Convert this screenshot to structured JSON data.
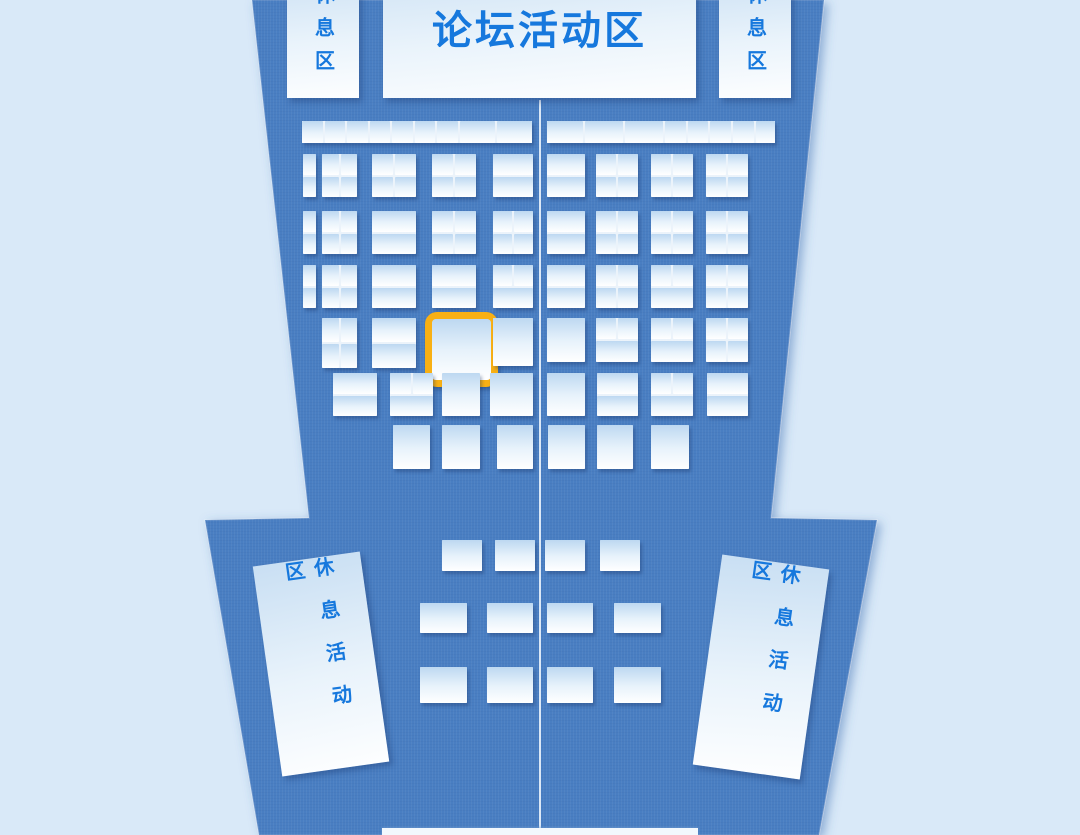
{
  "colors": {
    "background": "#d9e9f8",
    "hall_floor": "#4a7ec2",
    "hall_edge_shadow": "#3a6db0",
    "booth_top": "#bdd8f1",
    "booth_bottom": "#ffffff",
    "label_blue": "#1678dd",
    "highlight_accent": "#f8b014"
  },
  "hall": {
    "outline": [
      [
        252,
        0
      ],
      [
        824,
        0
      ],
      [
        771,
        518
      ],
      [
        877,
        520
      ],
      [
        819,
        835
      ],
      [
        259,
        835
      ],
      [
        205,
        520
      ],
      [
        309,
        518
      ]
    ]
  },
  "aisle": {
    "x": 539,
    "y": 100,
    "w": 2,
    "h": 728
  },
  "entrance": {
    "x": 382,
    "y": 828,
    "w": 316,
    "h": 7
  },
  "panels": {
    "forum": {
      "label": "论坛活动区",
      "x": 383,
      "y": -45,
      "w": 313,
      "h": 143,
      "angle": 0
    },
    "rest_top_left": {
      "label": "休息区",
      "x": 287,
      "y": -32,
      "w": 72,
      "h": 130,
      "angle": 0
    },
    "rest_top_right": {
      "label": "休息区",
      "x": 719,
      "y": -32,
      "w": 72,
      "h": 130,
      "angle": 0
    },
    "rest_bottom_left": {
      "label": "休息活动区",
      "x": 267,
      "y": 558,
      "w": 108,
      "h": 212,
      "angle": -8
    },
    "rest_bottom_right": {
      "label": "休息活动区",
      "x": 707,
      "y": 561,
      "w": 108,
      "h": 212,
      "angle": 8
    }
  },
  "booth_map": {
    "selected_booth_present": true,
    "cluster_types": {
      "s": "single booth",
      "v": "two stacked booths",
      "q": "2x2 booth block",
      "t": "two top booths + one wide bottom booth",
      "cols": "strip of stalls"
    },
    "clusters": [
      {
        "x": 302,
        "y": 121,
        "w": 230,
        "h": 22,
        "t": "cols",
        "cols": [
          22,
          22,
          22,
          22,
          22,
          22,
          22,
          37,
          38
        ]
      },
      {
        "x": 547,
        "y": 121,
        "w": 228,
        "h": 22,
        "t": "cols",
        "cols": [
          38,
          40,
          40,
          22,
          22,
          22,
          22,
          20
        ]
      },
      {
        "x": 303,
        "y": 154,
        "w": 13,
        "h": 43,
        "t": "v"
      },
      {
        "x": 322,
        "y": 154,
        "w": 35,
        "h": 43,
        "t": "q"
      },
      {
        "x": 372,
        "y": 154,
        "w": 44,
        "h": 43,
        "t": "q"
      },
      {
        "x": 432,
        "y": 154,
        "w": 44,
        "h": 43,
        "t": "q"
      },
      {
        "x": 493,
        "y": 154,
        "w": 40,
        "h": 43,
        "t": "v"
      },
      {
        "x": 547,
        "y": 154,
        "w": 38,
        "h": 43,
        "t": "v"
      },
      {
        "x": 596,
        "y": 154,
        "w": 42,
        "h": 43,
        "t": "q"
      },
      {
        "x": 651,
        "y": 154,
        "w": 42,
        "h": 43,
        "t": "q"
      },
      {
        "x": 706,
        "y": 154,
        "w": 42,
        "h": 43,
        "t": "q"
      },
      {
        "x": 303,
        "y": 211,
        "w": 13,
        "h": 43,
        "t": "v"
      },
      {
        "x": 322,
        "y": 211,
        "w": 35,
        "h": 43,
        "t": "q"
      },
      {
        "x": 372,
        "y": 211,
        "w": 44,
        "h": 43,
        "t": "v"
      },
      {
        "x": 432,
        "y": 211,
        "w": 44,
        "h": 43,
        "t": "q"
      },
      {
        "x": 493,
        "y": 211,
        "w": 40,
        "h": 43,
        "t": "q"
      },
      {
        "x": 547,
        "y": 211,
        "w": 38,
        "h": 43,
        "t": "v"
      },
      {
        "x": 596,
        "y": 211,
        "w": 42,
        "h": 43,
        "t": "q"
      },
      {
        "x": 651,
        "y": 211,
        "w": 42,
        "h": 43,
        "t": "q"
      },
      {
        "x": 706,
        "y": 211,
        "w": 42,
        "h": 43,
        "t": "q"
      },
      {
        "x": 303,
        "y": 265,
        "w": 13,
        "h": 43,
        "t": "v"
      },
      {
        "x": 322,
        "y": 265,
        "w": 35,
        "h": 43,
        "t": "q"
      },
      {
        "x": 372,
        "y": 265,
        "w": 44,
        "h": 43,
        "t": "v"
      },
      {
        "x": 432,
        "y": 265,
        "w": 44,
        "h": 43,
        "t": "v"
      },
      {
        "x": 493,
        "y": 265,
        "w": 40,
        "h": 43,
        "t": "t"
      },
      {
        "x": 547,
        "y": 265,
        "w": 38,
        "h": 43,
        "t": "v"
      },
      {
        "x": 596,
        "y": 265,
        "w": 42,
        "h": 43,
        "t": "q"
      },
      {
        "x": 651,
        "y": 265,
        "w": 42,
        "h": 43,
        "t": "t"
      },
      {
        "x": 706,
        "y": 265,
        "w": 42,
        "h": 43,
        "t": "q"
      },
      {
        "x": 322,
        "y": 318,
        "w": 35,
        "h": 50,
        "t": "q"
      },
      {
        "x": 372,
        "y": 318,
        "w": 44,
        "h": 50,
        "t": "v"
      },
      {
        "x": 425,
        "y": 312,
        "w": 59,
        "h": 61,
        "t": "s",
        "hl": true
      },
      {
        "x": 493,
        "y": 318,
        "w": 40,
        "h": 48,
        "t": "s"
      },
      {
        "x": 547,
        "y": 318,
        "w": 38,
        "h": 44,
        "t": "s"
      },
      {
        "x": 596,
        "y": 318,
        "w": 42,
        "h": 44,
        "t": "t"
      },
      {
        "x": 651,
        "y": 318,
        "w": 42,
        "h": 44,
        "t": "t"
      },
      {
        "x": 706,
        "y": 318,
        "w": 42,
        "h": 44,
        "t": "q"
      },
      {
        "x": 333,
        "y": 373,
        "w": 44,
        "h": 43,
        "t": "v"
      },
      {
        "x": 390,
        "y": 373,
        "w": 43,
        "h": 43,
        "t": "t"
      },
      {
        "x": 442,
        "y": 373,
        "w": 38,
        "h": 43,
        "t": "s"
      },
      {
        "x": 490,
        "y": 373,
        "w": 43,
        "h": 43,
        "t": "s"
      },
      {
        "x": 547,
        "y": 373,
        "w": 38,
        "h": 43,
        "t": "s"
      },
      {
        "x": 597,
        "y": 373,
        "w": 41,
        "h": 43,
        "t": "v"
      },
      {
        "x": 651,
        "y": 373,
        "w": 42,
        "h": 43,
        "t": "t"
      },
      {
        "x": 707,
        "y": 373,
        "w": 41,
        "h": 43,
        "t": "v"
      },
      {
        "x": 393,
        "y": 425,
        "w": 37,
        "h": 44,
        "t": "s"
      },
      {
        "x": 442,
        "y": 425,
        "w": 38,
        "h": 44,
        "t": "s"
      },
      {
        "x": 497,
        "y": 425,
        "w": 36,
        "h": 44,
        "t": "s"
      },
      {
        "x": 548,
        "y": 425,
        "w": 37,
        "h": 44,
        "t": "s"
      },
      {
        "x": 597,
        "y": 425,
        "w": 36,
        "h": 44,
        "t": "s"
      },
      {
        "x": 651,
        "y": 425,
        "w": 38,
        "h": 44,
        "t": "s"
      },
      {
        "x": 442,
        "y": 540,
        "w": 40,
        "h": 31,
        "t": "s"
      },
      {
        "x": 495,
        "y": 540,
        "w": 40,
        "h": 31,
        "t": "s"
      },
      {
        "x": 545,
        "y": 540,
        "w": 40,
        "h": 31,
        "t": "s"
      },
      {
        "x": 600,
        "y": 540,
        "w": 40,
        "h": 31,
        "t": "s"
      },
      {
        "x": 420,
        "y": 603,
        "w": 47,
        "h": 30,
        "t": "s"
      },
      {
        "x": 487,
        "y": 603,
        "w": 46,
        "h": 30,
        "t": "s"
      },
      {
        "x": 547,
        "y": 603,
        "w": 46,
        "h": 30,
        "t": "s"
      },
      {
        "x": 614,
        "y": 603,
        "w": 47,
        "h": 30,
        "t": "s"
      },
      {
        "x": 420,
        "y": 667,
        "w": 47,
        "h": 36,
        "t": "s"
      },
      {
        "x": 487,
        "y": 667,
        "w": 46,
        "h": 36,
        "t": "s"
      },
      {
        "x": 547,
        "y": 667,
        "w": 46,
        "h": 36,
        "t": "s"
      },
      {
        "x": 614,
        "y": 667,
        "w": 47,
        "h": 36,
        "t": "s"
      }
    ]
  }
}
